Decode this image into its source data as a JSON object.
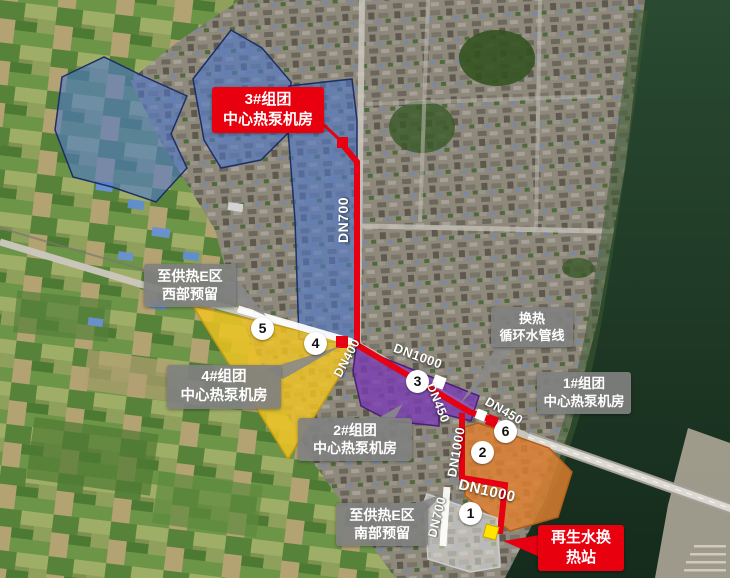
{
  "map": {
    "description_visible_text_only": true,
    "colors": {
      "pipe_red": "#e60012",
      "zone_blue": "#4f78cc",
      "zone_yellow": "#f2c522",
      "zone_purple": "#7a3bb5",
      "zone_orange": "#e08030",
      "zone_reserved_white": "#ececec",
      "marker_yellow": "#ffe400",
      "callout_gray": "#828282",
      "water_dark": "#1c3423"
    },
    "callouts": {
      "station3": {
        "line1": "3#组团",
        "line2": "中心热泵机房"
      },
      "station4": {
        "line1": "4#组团",
        "line2": "中心热泵机房"
      },
      "station2": {
        "line1": "2#组团",
        "line2": "中心热泵机房"
      },
      "station1": {
        "line1": "1#组团",
        "line2": "中心热泵机房"
      },
      "west_reserve": {
        "line1": "至供热E区",
        "line2": "西部预留"
      },
      "south_reserve": {
        "line1": "至供热E区",
        "line2": "南部预留"
      },
      "exchange_loop": {
        "line1": "换热",
        "line2": "循环水管线"
      },
      "regen_station": {
        "line1": "再生水换",
        "line2": "热站"
      }
    },
    "pipe_labels": [
      "DN700",
      "DN400",
      "DN1000",
      "DN450",
      "DN450",
      "DN1000",
      "DN1000",
      "DN700"
    ],
    "node_numbers": [
      "5",
      "4",
      "3",
      "6",
      "2",
      "1"
    ]
  }
}
